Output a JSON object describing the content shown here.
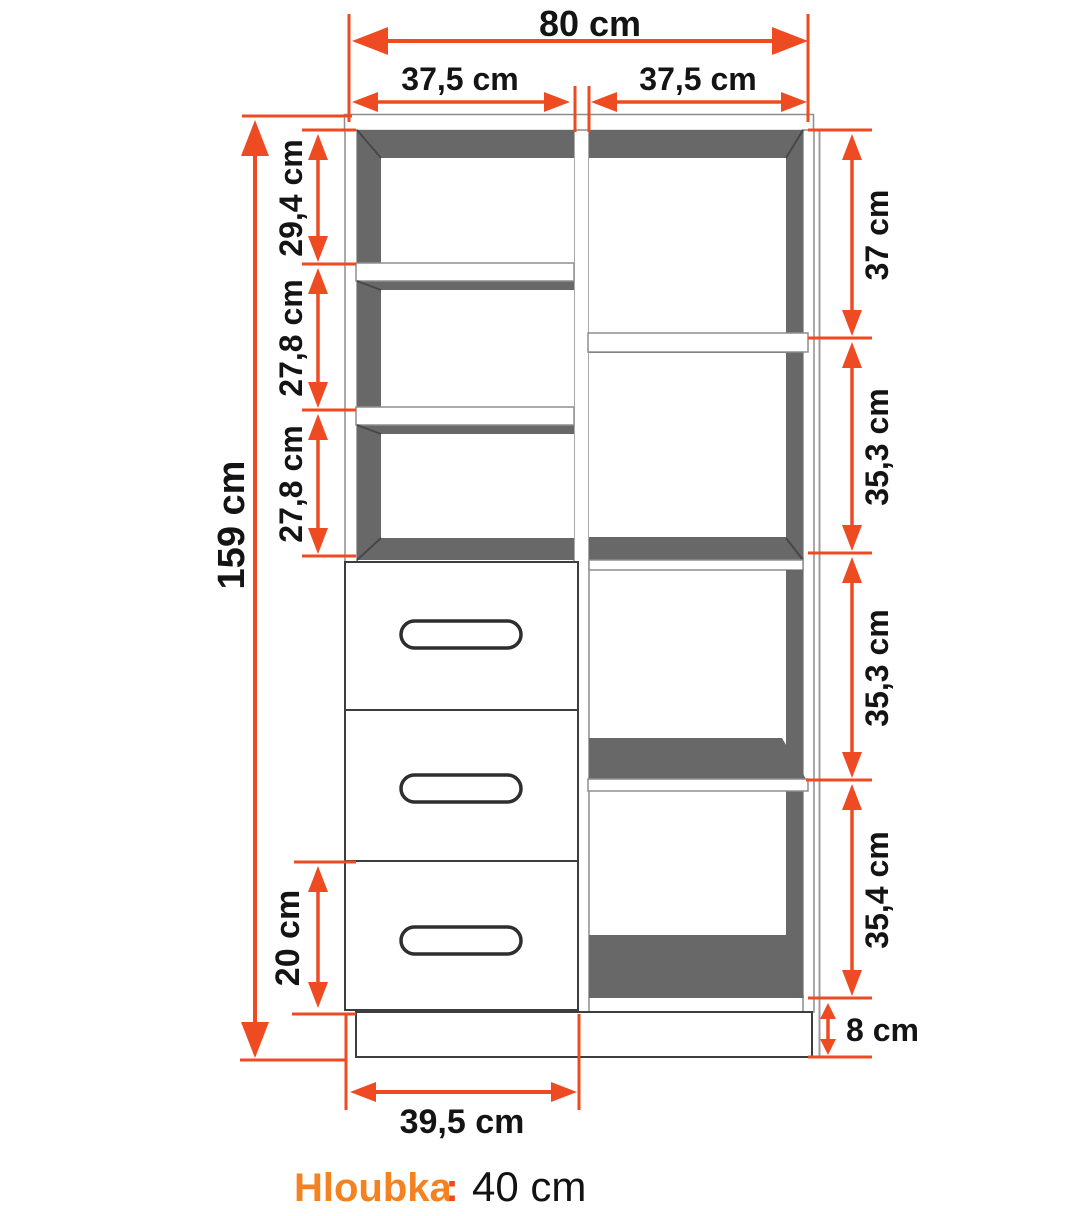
{
  "dims": {
    "total_width": "80 cm",
    "left_col_width": "37,5 cm",
    "right_col_width": "37,5 cm",
    "total_height": "159 cm",
    "left_sec1": "29,4 cm",
    "left_sec2": "27,8 cm",
    "left_sec3": "27,8 cm",
    "right_sec1": "37 cm",
    "right_sec2": "35,3 cm",
    "right_sec3": "35,3 cm",
    "right_sec4": "35,4 cm",
    "bottom_drawer_height": "20 cm",
    "drawer_width": "39,5 cm",
    "plinth_height": "8 cm"
  },
  "footer": {
    "label": "Hloubka",
    "colon": ":",
    "value": "40 cm"
  },
  "colors": {
    "dimension_red": "#ee4b23",
    "accent_orange": "#f58220",
    "cabinet_dark_gray": "#686868",
    "structure_gray": "#8d8d8d"
  }
}
